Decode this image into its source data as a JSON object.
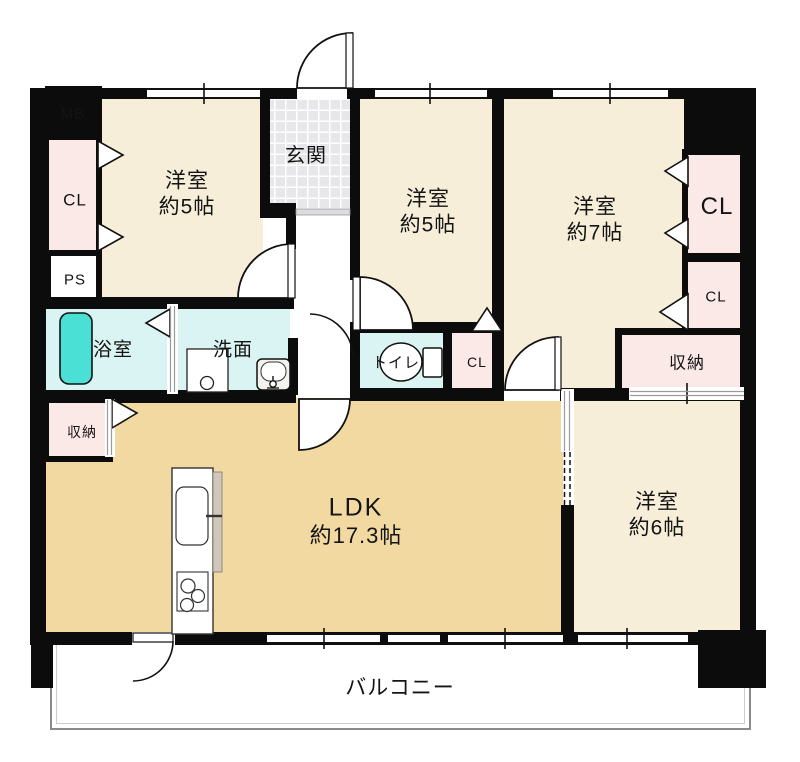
{
  "palette": {
    "wall": "#0c0c0c",
    "room_cream": "#f6eed9",
    "ldk_tan": "#f2d9a1",
    "wet_cyan": "#d9f4f2",
    "closet_pink": "#fbe9e7",
    "bathtub": "#4ae0d6",
    "tile_gray": "#e7e7ea",
    "balcony_border": "#8a8a8a"
  },
  "rooms": {
    "yoshitsu5_left": {
      "label1": "洋室",
      "label2": "約5帖"
    },
    "yoshitsu5_mid": {
      "label1": "洋室",
      "label2": "約5帖"
    },
    "yoshitsu7": {
      "label1": "洋室",
      "label2": "約7帖"
    },
    "yoshitsu6": {
      "label1": "洋室",
      "label2": "約6帖"
    },
    "ldk": {
      "label1": "LDK",
      "label2": "約17.3帖"
    },
    "genkan": {
      "label": "玄関"
    },
    "bath": {
      "label": "浴室"
    },
    "senmen": {
      "label": "洗面"
    },
    "toilet": {
      "label": "トイレ"
    },
    "balcony": {
      "label": "バルコニー"
    }
  },
  "storage": {
    "cl_left": {
      "label": "CL"
    },
    "cl_mid": {
      "label": "CL"
    },
    "cl_right_top": {
      "label": "CL"
    },
    "cl_right_mid": {
      "label": "CL"
    },
    "shuno_left": {
      "label": "収納"
    },
    "shuno_right": {
      "label": "収納"
    }
  },
  "utilities": {
    "mb": {
      "label": "MB"
    },
    "ps": {
      "label": "PS"
    }
  }
}
